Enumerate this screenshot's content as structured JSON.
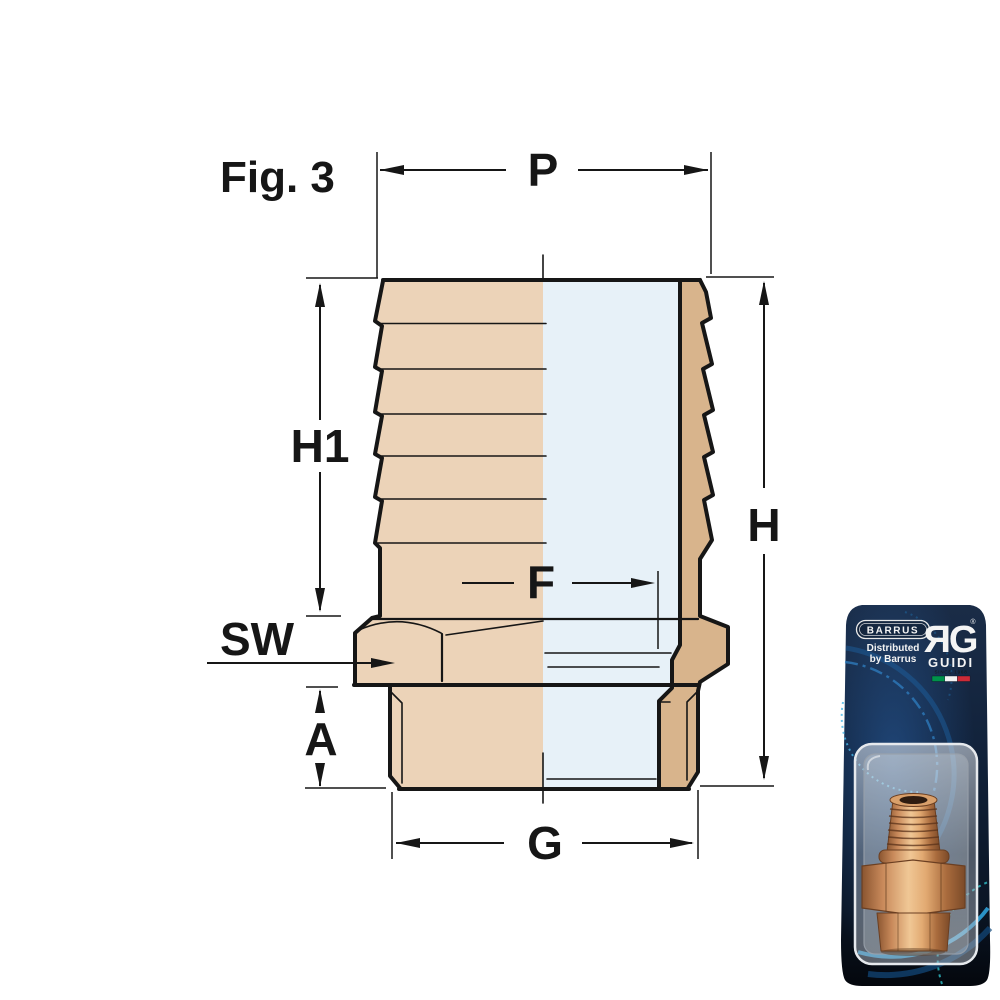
{
  "figure": {
    "label": "Fig. 3"
  },
  "dimensions": {
    "p": "P",
    "h1": "H1",
    "h": "H",
    "f": "F",
    "sw": "SW",
    "a": "A",
    "g": "G"
  },
  "drawing": {
    "body_color": "#ecd3b8",
    "body_color_dark": "#d8b48c",
    "bore_color": "#e7f1f8",
    "outline_color": "#161616"
  },
  "packaging": {
    "brand_badge": "BARRUS",
    "distributed_line1": "Distributed",
    "distributed_line2": "by Barrus",
    "logo_monogram": "ЯG",
    "logo_mark": "®",
    "logo_name": "GUIDI",
    "logo_tagline": "SINCE 1968",
    "flag_colors": [
      "#00924a",
      "#f4f4f4",
      "#cd2b37"
    ],
    "card_color": "#101f33",
    "accent_blue": "#2f9ad0"
  }
}
